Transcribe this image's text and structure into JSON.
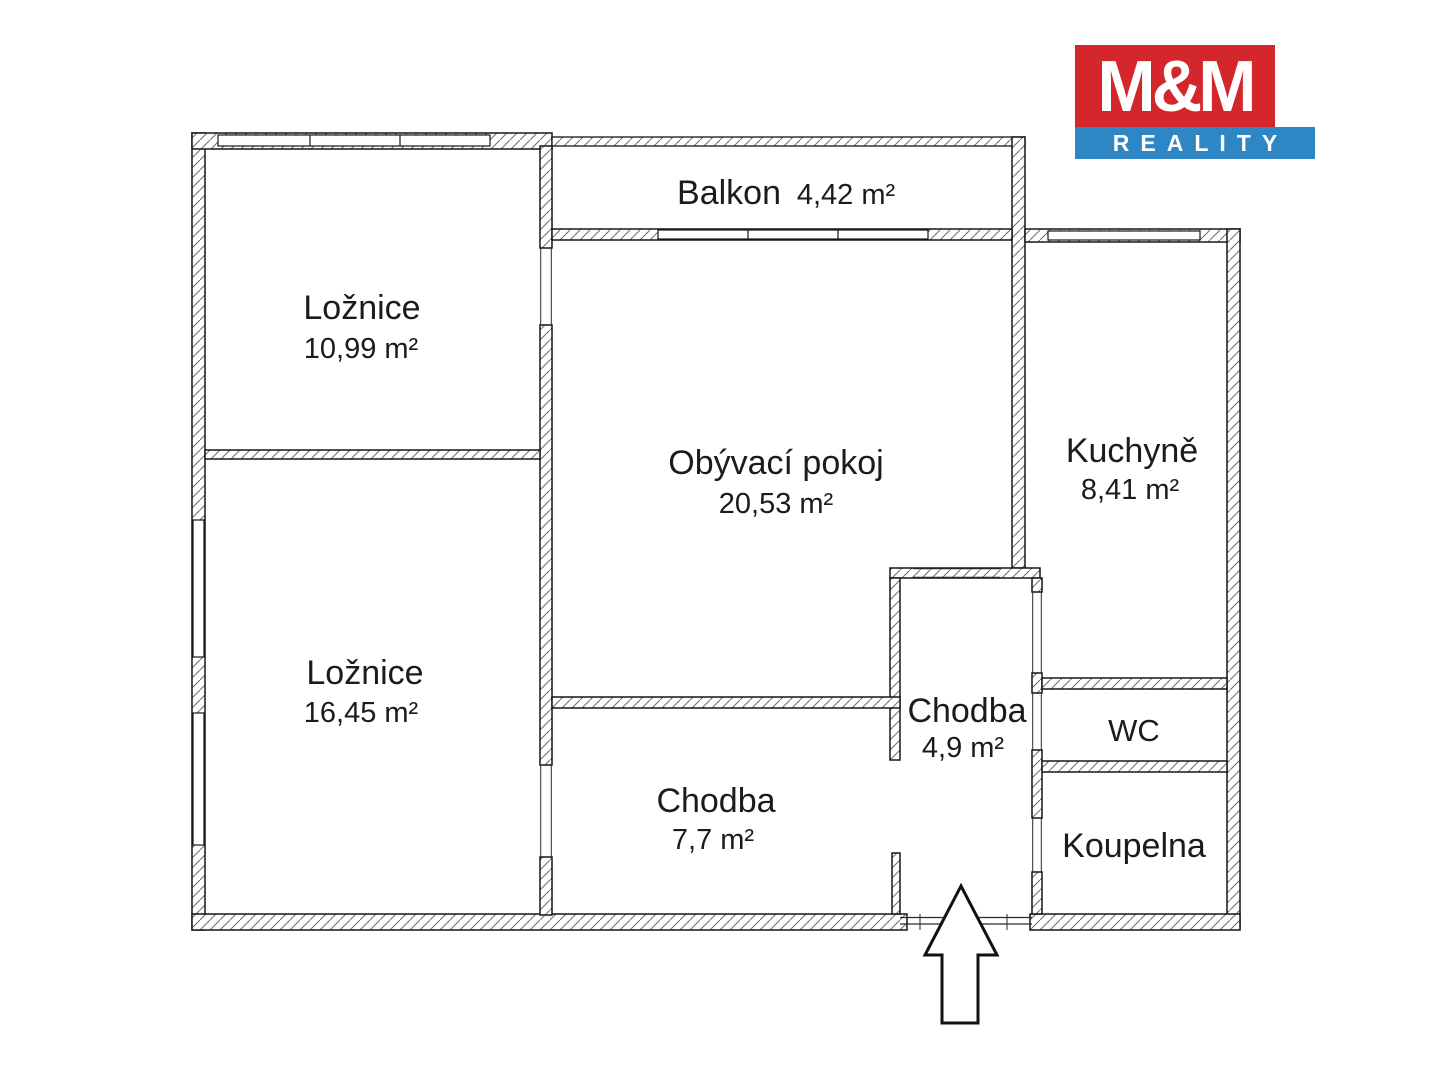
{
  "logo": {
    "line1": "M&M",
    "line2": "REALITY",
    "red": "#d4272c",
    "blue": "#2e86c5"
  },
  "rooms": {
    "balkon": {
      "name": "Balkon",
      "area": "4,42 m²"
    },
    "loznice_horni": {
      "name": "Ložnice",
      "area": "10,99 m²"
    },
    "obyvaci_pokoj": {
      "name": "Obývací pokoj",
      "area": "20,53 m²"
    },
    "kuchyne": {
      "name": "Kuchyně",
      "area": "8,41 m²"
    },
    "chodba_mala": {
      "name": "Chodba",
      "area": "4,9 m²"
    },
    "wc": {
      "name": "WC"
    },
    "loznice_dolni": {
      "name": "Ložnice",
      "area": "16,45 m²"
    },
    "chodba_velka": {
      "name": "Chodba",
      "area": "7,7 m²"
    },
    "koupelna": {
      "name": "Koupelna"
    }
  }
}
